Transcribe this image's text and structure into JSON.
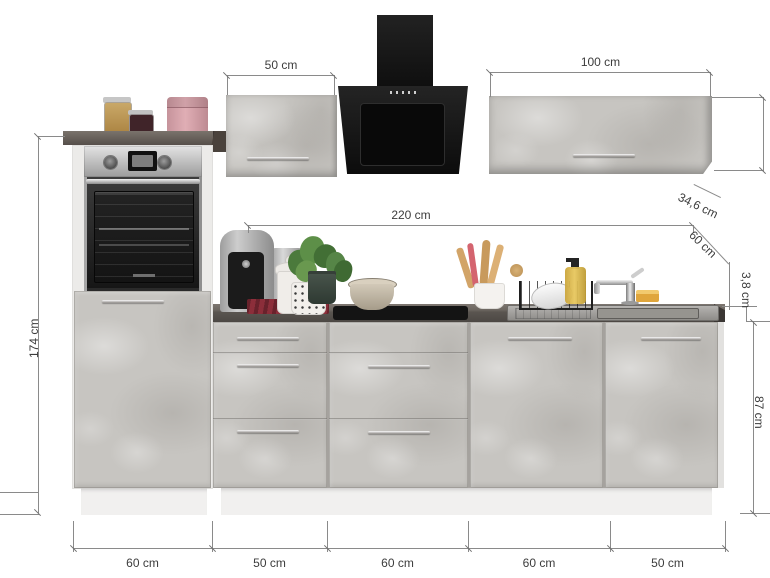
{
  "dims": {
    "wall_cabinet_left_width": "50 cm",
    "wall_cabinet_right_width": "100 cm",
    "wall_cabinet_right_depth": "34,6 cm",
    "worktop_length": "220 cm",
    "worktop_depth": "60 cm",
    "worktop_thickness": "3,8 cm",
    "base_cabinet_height": "87 cm",
    "tall_cabinet_height": "174 cm",
    "base_widths": [
      "60 cm",
      "50 cm",
      "60 cm",
      "60 cm",
      "50 cm"
    ]
  },
  "colors": {
    "cabinet_front_concrete": "#c7c5c1",
    "worktop_dark": "#56524e",
    "hood_black": "#141414",
    "carcass_white": "#ecebe9",
    "dimension_line": "#8a8a8a",
    "dimension_text": "#3c3c3c"
  }
}
